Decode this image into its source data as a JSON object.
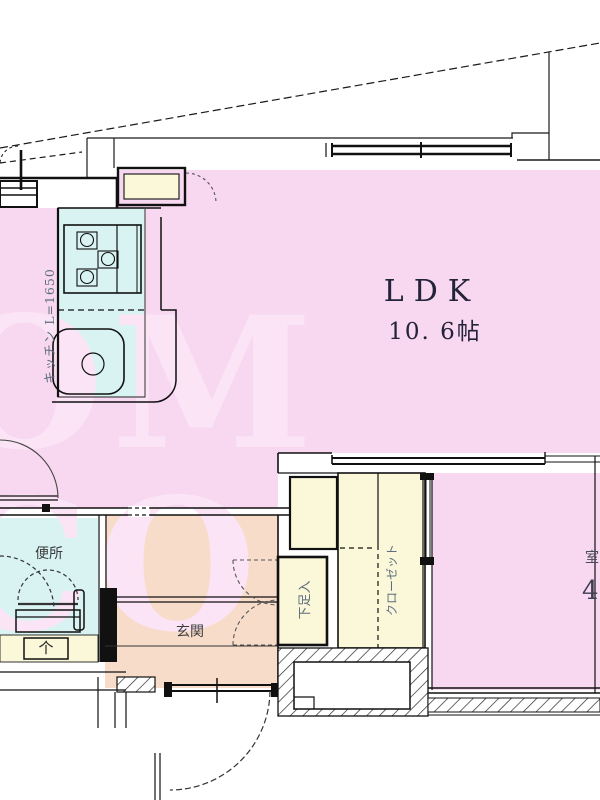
{
  "watermark": {
    "text": "OM CO"
  },
  "rooms": {
    "ldk": {
      "name": "LDK",
      "size": "10. 6帖"
    },
    "kitchen": {
      "label": "キッチン L=1650"
    },
    "toilet": {
      "label": "便所"
    },
    "entrance": {
      "label": "玄関"
    },
    "shoe_cabinet": {
      "label": "下足入"
    },
    "closet": {
      "label": "クローゼット"
    },
    "bedroom": {
      "label_fragment": "室",
      "size_fragment": "4"
    },
    "meter_box": {
      "symbol": "个"
    }
  },
  "colors": {
    "room_pink": "#f8d7f0",
    "water_blue": "#d9f3f3",
    "entrance_salmon": "#f8dcca",
    "storage_yellow": "#faf8d8",
    "watermark_pink": "#fbe4f6",
    "line_dark": "#1a1a1a",
    "white": "#ffffff"
  }
}
